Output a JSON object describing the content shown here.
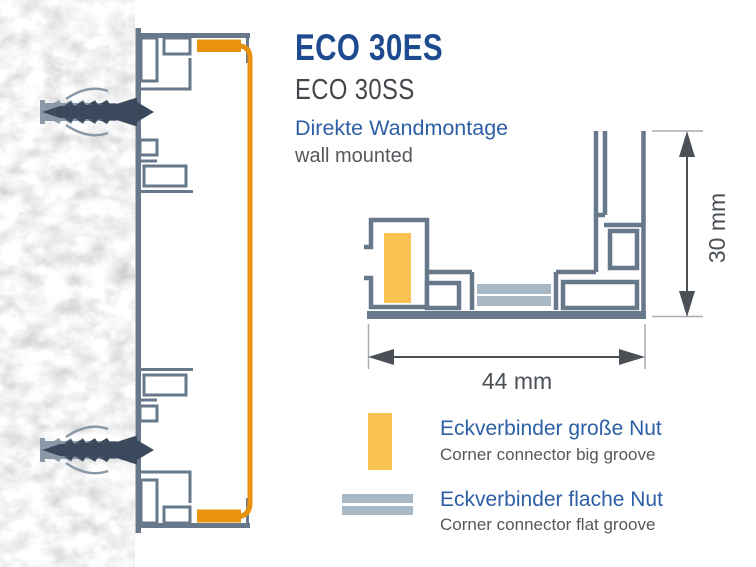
{
  "product": {
    "title": "ECO 30ES",
    "variant": "ECO 30SS",
    "mounting_de": "Direkte Wandmontage",
    "mounting_en": "wall mounted"
  },
  "dimensions": {
    "height_label": "30 mm",
    "width_label": "44 mm"
  },
  "legend": {
    "items": [
      {
        "swatch": "big-groove-connector",
        "label_de": "Eckverbinder große Nut",
        "label_en": "Corner connector big groove"
      },
      {
        "swatch": "flat-groove-connector",
        "label_de": "Eckverbinder flache Nut",
        "label_en": "Corner connector flat groove"
      }
    ]
  },
  "colors": {
    "title_blue": "#1E4B8F",
    "label_blue": "#2C5FA5",
    "text_gray": "#55585C",
    "dimension_gray": "#4A5056",
    "profile_outline": "#66788A",
    "groove_big": "#F9C453",
    "groove_big_side": "#E8920E",
    "groove_flat": "#A9B8C5",
    "anchor_dowel": "#8A99A8",
    "anchor_screw": "#3A4A5C",
    "wall_base": "#E9E9E9"
  }
}
